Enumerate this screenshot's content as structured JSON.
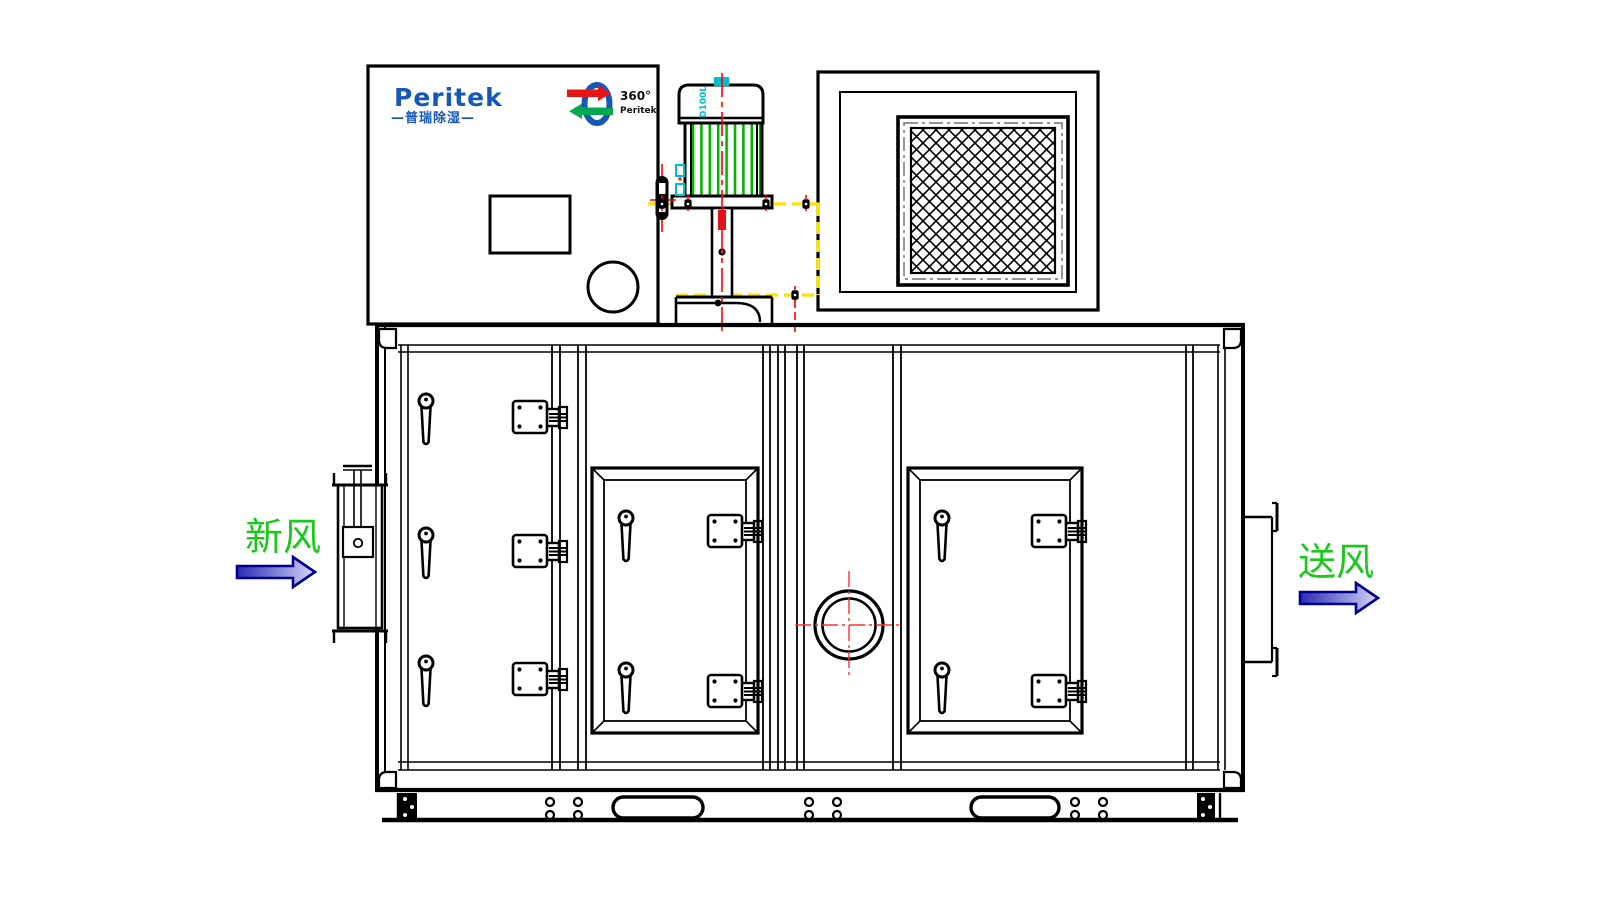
{
  "brand": {
    "logo_text": "Peritek",
    "logo_subtext": "—普瑞除湿—",
    "emblem_line1": "360°",
    "emblem_line2": "Peritek"
  },
  "motor": {
    "model_label": "D100L"
  },
  "flow_labels": {
    "inlet": "新风",
    "outlet": "送风"
  },
  "colors": {
    "line_black": "#000000",
    "centerline_red": "#ff0000",
    "hidden_line_yellow": "#ffe400",
    "label_green": "#1dc81d",
    "motor_fin_green": "#00b400",
    "brand_blue": "#1658b8",
    "cyan_accent": "#00bcd0",
    "arrow_outline_navy": "#00008b",
    "arrow_fill_dark": "#2a2ab4",
    "arrow_fill_light": "#d4d4fb"
  }
}
